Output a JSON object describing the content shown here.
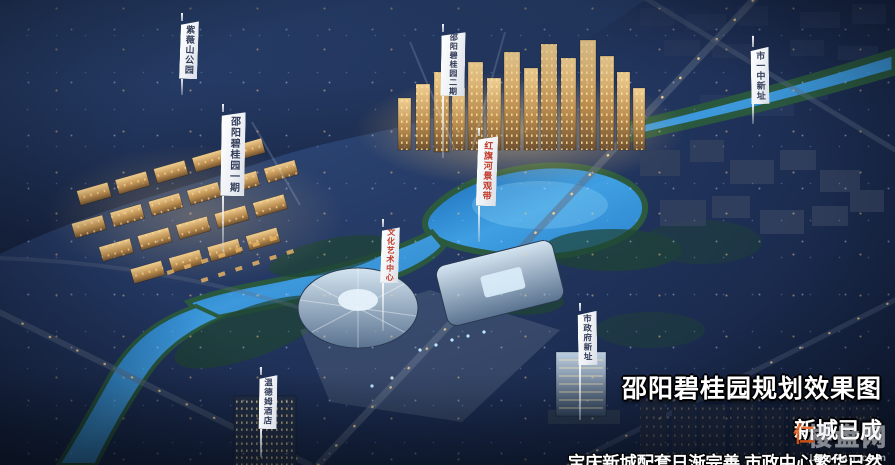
{
  "image": {
    "kind": "aerial night masterplan rendering",
    "subject": "邵阳碧桂园规划效果图"
  },
  "banners": [
    {
      "id": "park",
      "label": "紫薇山公园",
      "text_color": "#323c58"
    },
    {
      "id": "phase1",
      "label": "邵阳碧桂园一期",
      "text_color": "#323c58"
    },
    {
      "id": "phase2",
      "label": "邵阳碧桂园二期",
      "text_color": "#323c58"
    },
    {
      "id": "river",
      "label": "红旗河景观带",
      "text_color": "#c23b28"
    },
    {
      "id": "school",
      "label": "市一中新址",
      "text_color": "#323c58"
    },
    {
      "id": "art",
      "label": "文化艺术中心",
      "text_color": "#c23b28"
    },
    {
      "id": "hotel",
      "label": "温德姆酒店",
      "text_color": "#323c58"
    },
    {
      "id": "gov",
      "label": "市政府新址",
      "text_color": "#323c58"
    }
  ],
  "caption": {
    "title": "邵阳碧桂园规划效果图",
    "subtitle": "新城已成",
    "tagline": "宝庆新城配套日渐完善 市政中心繁华已然",
    "text_color": "#ffffff"
  },
  "watermark": {
    "name": "楼盘网",
    "logo_glyph": "仁",
    "domain": "LouPan.com",
    "accent_color": "#e95e1a"
  },
  "palette": {
    "sky": "#223457",
    "water": "#3b9be0",
    "building_glow": "#eec27a",
    "bank_green": "#2b5a3e"
  }
}
